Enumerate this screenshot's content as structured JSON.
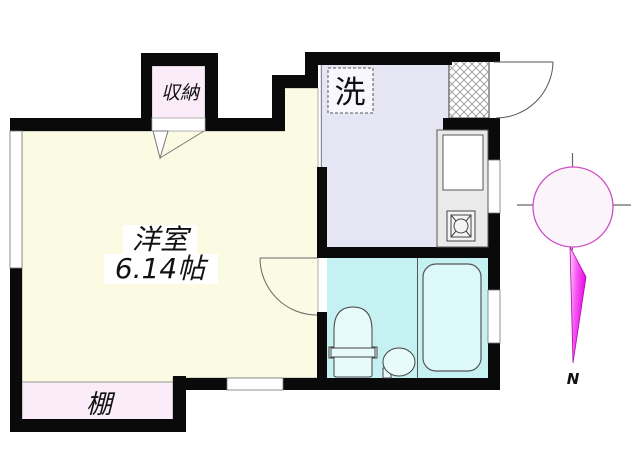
{
  "rooms": {
    "main": {
      "name": "洋室",
      "size": "6.14帖"
    },
    "closet": {
      "label": "収納"
    },
    "laundry": {
      "label": "洗"
    },
    "shelf": {
      "label": "棚"
    }
  },
  "compass": {
    "north_label": "N"
  },
  "colors": {
    "wall": "#0a0a0a",
    "main_room_fill": "#fbfbe3",
    "closet_fill": "#faecf8",
    "shelf_fill": "#faecf8",
    "kitchen_fill": "#e5e5f4",
    "laundry_box_fill": "#f7f7fd",
    "bath_fill": "#c6f1f3",
    "tub_fill": "#ddf8f8",
    "fixture_fill": "#e8fbfb",
    "counter_fill": "#eaeaea",
    "sink_fill": "#ffffff",
    "compass_circle_stroke": "#cc4fc4",
    "compass_circle_fill": "#fcf4fb",
    "needle_color": "#e600e6",
    "north_label_color": "#e00000"
  }
}
